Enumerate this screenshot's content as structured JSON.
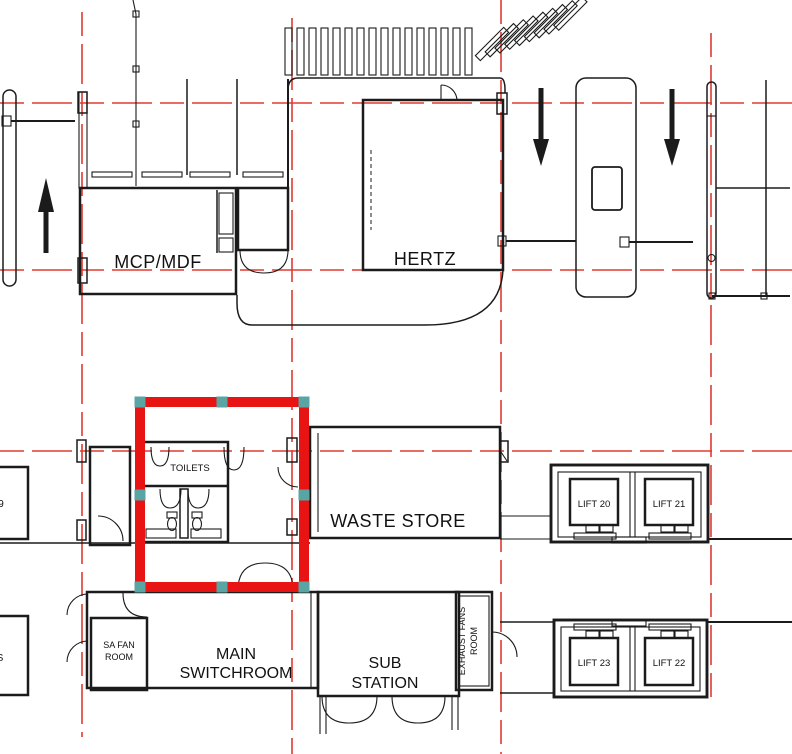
{
  "colors": {
    "background": "#ffffff",
    "line": "#1b1b1b",
    "grid_red": "#e03a30",
    "selection_red": "#e81414",
    "handle_teal": "#58a5a3"
  },
  "rooms": {
    "mcp_mdf": {
      "label": "MCP/MDF"
    },
    "hertz": {
      "label": "HERTZ"
    },
    "toilets": {
      "label": "TOILETS"
    },
    "waste_store": {
      "label": "WASTE STORE"
    },
    "lift_20": {
      "label": "LIFT 20"
    },
    "lift_21": {
      "label": "LIFT 21"
    },
    "lift_22": {
      "label": "LIFT 22"
    },
    "lift_23": {
      "label": "LIFT 23"
    },
    "main_switchroom": {
      "label_line1": "MAIN",
      "label_line2": "SWITCHROOM"
    },
    "sub_station": {
      "label_line1": "SUB",
      "label_line2": "STATION"
    },
    "sa_fan_room": {
      "label_line1": "SA FAN",
      "label_line2": "ROOM"
    },
    "exhaust_fans_room": {
      "label_line1": "EXHAUST FANS",
      "label_line2": "ROOM"
    },
    "partial_room_left_mid": {
      "label": "9"
    },
    "partial_room_left_bottom": {
      "label": "S"
    }
  },
  "selection": {
    "target": "toilets-area",
    "handle_count": "8"
  }
}
